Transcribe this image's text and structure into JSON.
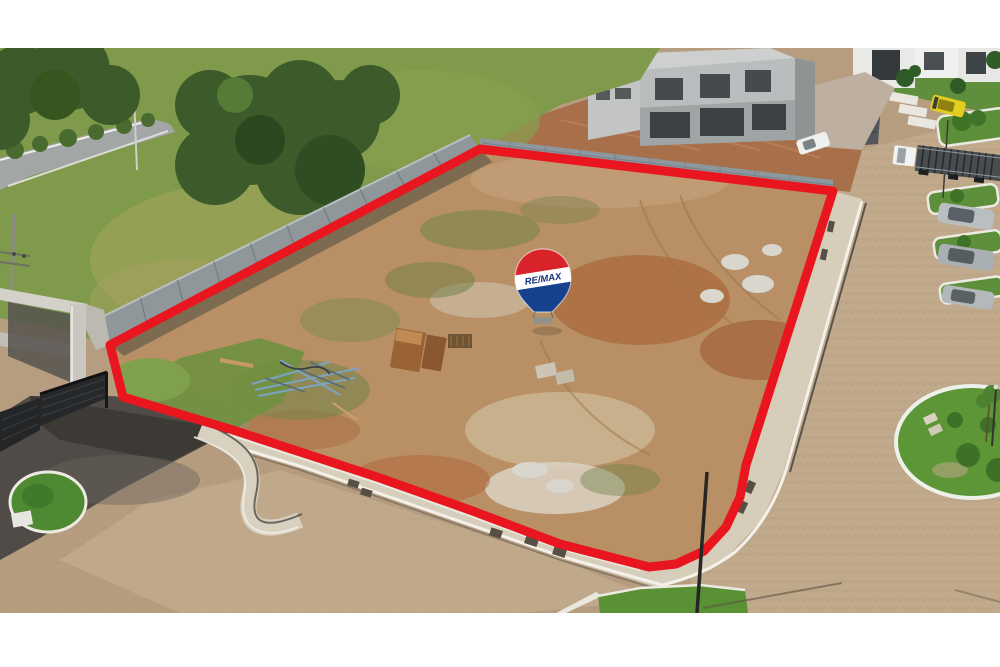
{
  "photo": {
    "kind": "aerial-drone-photo-of-vacant-lot-for-sale",
    "letterbox": "#ffffff"
  },
  "balloon": {
    "brand": "RE/MAX",
    "color_red": "#d8232a",
    "color_white": "#ffffff",
    "color_blue": "#16418c",
    "text_color": "#16317e",
    "basket_color": "#93918a"
  },
  "boundary": {
    "color": "#e9161f",
    "stroke_width": 9,
    "points": "110,345 480,149 833,191 746,465 740,497 726,527 704,551 676,564 649,567 560,544 470,510 377,477 233,430 123,397"
  },
  "palette": {
    "lawn": "#7f9a4b",
    "tree": "#3c5a2a",
    "dirt": "#b99066",
    "dirt_orange": "#a96a3e",
    "sand": "#d3c3a4",
    "road_paver": "#b79d80",
    "asphalt": "#504b47",
    "sidewalk": "#d6cdbb",
    "wall": "#8f979b",
    "concrete_house": "#b9bdbd",
    "grass_island": "#5c9636",
    "curb_white": "#f3f1ea"
  }
}
